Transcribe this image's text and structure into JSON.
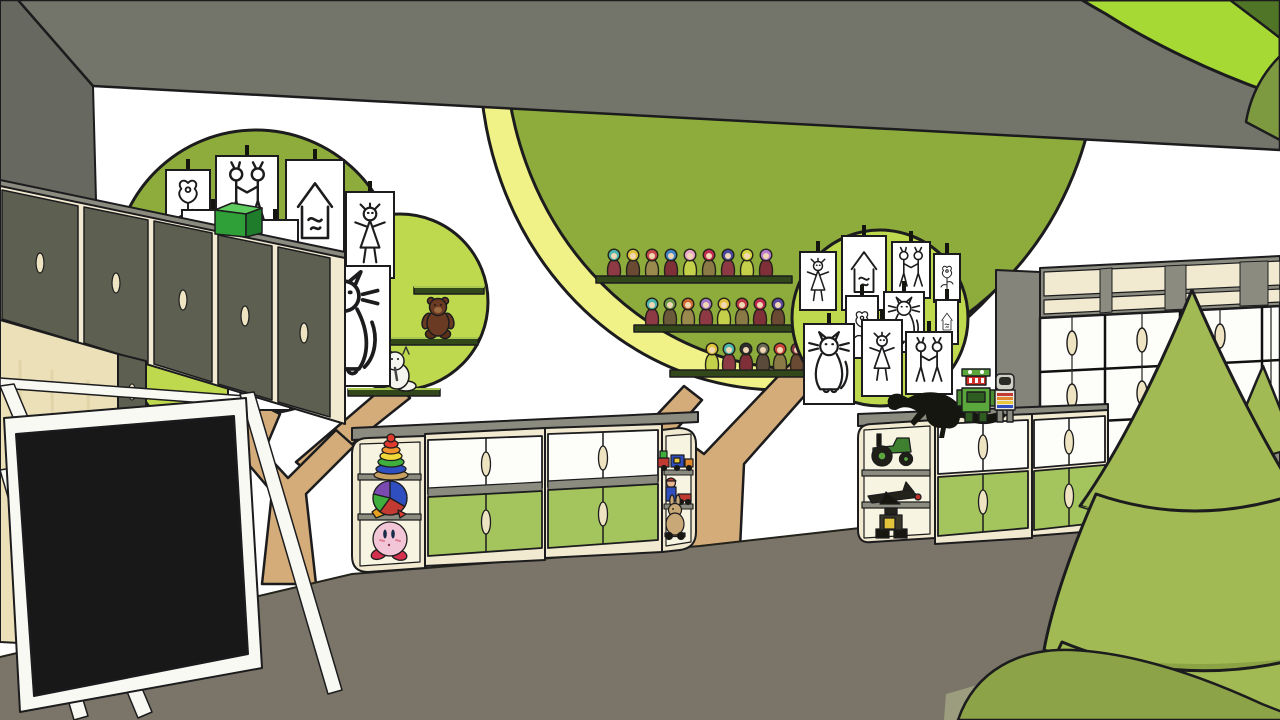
{
  "scene": {
    "objects": [
      "kindergarten playroom 3d render",
      "tree mural with children's drawings (left)",
      "tree mural with peg-doll shelves (center)",
      "tree mural with children's drawings (right)",
      "wall cabinets with dark doors (left)",
      "tv on white easel frame",
      "low toy cabinet with green and white doors (center)",
      "low toy cabinet with green and white doors (right)",
      "large cube shelving unit (right)",
      "playhouse with arched door",
      "stylized cone trees (foreground)",
      "green mound (foreground)",
      "foreground canopy leaves (top right)"
    ]
  },
  "palette": {
    "wall": "#ffffff",
    "ceiling": "#74756a",
    "side_wall": "#67685f",
    "floor": "#7a7568",
    "floor_light": "#a2a482",
    "canopy_olive": "#8dac3c",
    "canopy_light": "#bfd94f",
    "canopy_yellow": "#f0f287",
    "trunk": "#d3ac7a",
    "mural_shelf": "#33481a",
    "mural_shelf_edge": "#a9c850",
    "cream": "#f1ead0",
    "wood": "#ece0b8",
    "top_gray": "#8b8b80",
    "unit_gray": "#84847a",
    "door_dark": "#5d6051",
    "door_green": "#a4c45e",
    "door_white": "#fdfdfa",
    "handle": "#eee4c2",
    "leaf_bright": "#a7d934",
    "leaf_dark": "#507527",
    "leaf_mid": "#7e9a40",
    "cone": "#a1ba53",
    "cone_lip": "#8ba344",
    "cone_edge": "#2e3a18",
    "mound": "#8ca348",
    "house_gray": "#9b998c",
    "house_cream": "#f3ebc9",
    "house_inner": "#efe4bd",
    "tv": "#181818",
    "easel": "#f9f9f4",
    "box_front": "#2fa038",
    "box_side": "#1e7c2a",
    "box_top": "#5ecb5e",
    "teddy": "#6a3a22",
    "plush_white": "#f5f5ef",
    "kirby": "#f3c6d7",
    "kirby_feet": "#d5304e",
    "green_drawer": "#6b7b3c"
  },
  "drawings": {
    "left_tree": [
      "flower",
      "couple",
      "house",
      "girl",
      "house",
      "cat",
      "flower",
      "couple",
      "boy",
      "cat"
    ],
    "right_tree": [
      "girl",
      "house",
      "couple",
      "flower",
      "flower",
      "cat",
      "house",
      "cat",
      "girl",
      "couple"
    ]
  },
  "toys": {
    "peg_doll_rows": [
      {
        "heads": [
          "#4fb6ae",
          "#e2c33e",
          "#c64848",
          "#3f86c6",
          "#eaa8c8",
          "#c22c50",
          "#4a4aa0",
          "#d6d640",
          "#b87cd0"
        ],
        "bodies": [
          "#8d3a44",
          "#6b4a33",
          "#9a8a4e",
          "#7e2f38",
          "#c4d04a",
          "#8a7a45",
          "#8d3a44",
          "#c4d04a",
          "#7e2f38"
        ]
      },
      {
        "heads": [
          "#4fb6ae",
          "#6f9c4c",
          "#d06a32",
          "#a478c8",
          "#e2c33e",
          "#c03a44",
          "#c22c50",
          "#5a48a0"
        ],
        "bodies": [
          "#8d3a44",
          "#6b5a3a",
          "#9a8a4e",
          "#8d3a44",
          "#c4d04a",
          "#8a7a45",
          "#7e2f38",
          "#6b4a33"
        ]
      },
      {
        "heads": [
          "#e2c33e",
          "#4fb6ae",
          "#2e2e2e",
          "#6b6b58",
          "#cc4438",
          "#8d3a44"
        ],
        "bodies": [
          "#c4d04a",
          "#8d3a44",
          "#7e2f38",
          "#5a4a3a",
          "#8a7a45",
          "#6b4a33"
        ]
      }
    ],
    "plush_shelves": [
      "teddy-bear",
      "white-plush-cat"
    ],
    "left_cabinet_shelf_toys": [
      "ring-stacker",
      "puzzle-ball",
      "kirby-figure"
    ],
    "left_cabinet_end_toys": [
      "toy-train",
      "figure-with-car",
      "rabbit-on-wheels"
    ],
    "right_cabinet_shelf_toys": [
      "toy-tractor",
      "toy-plane",
      "wall-e-robot"
    ],
    "right_cabinet_top_toys": [
      "dinosaur-skeleton",
      "green-robot",
      "astronaut-figure"
    ]
  }
}
